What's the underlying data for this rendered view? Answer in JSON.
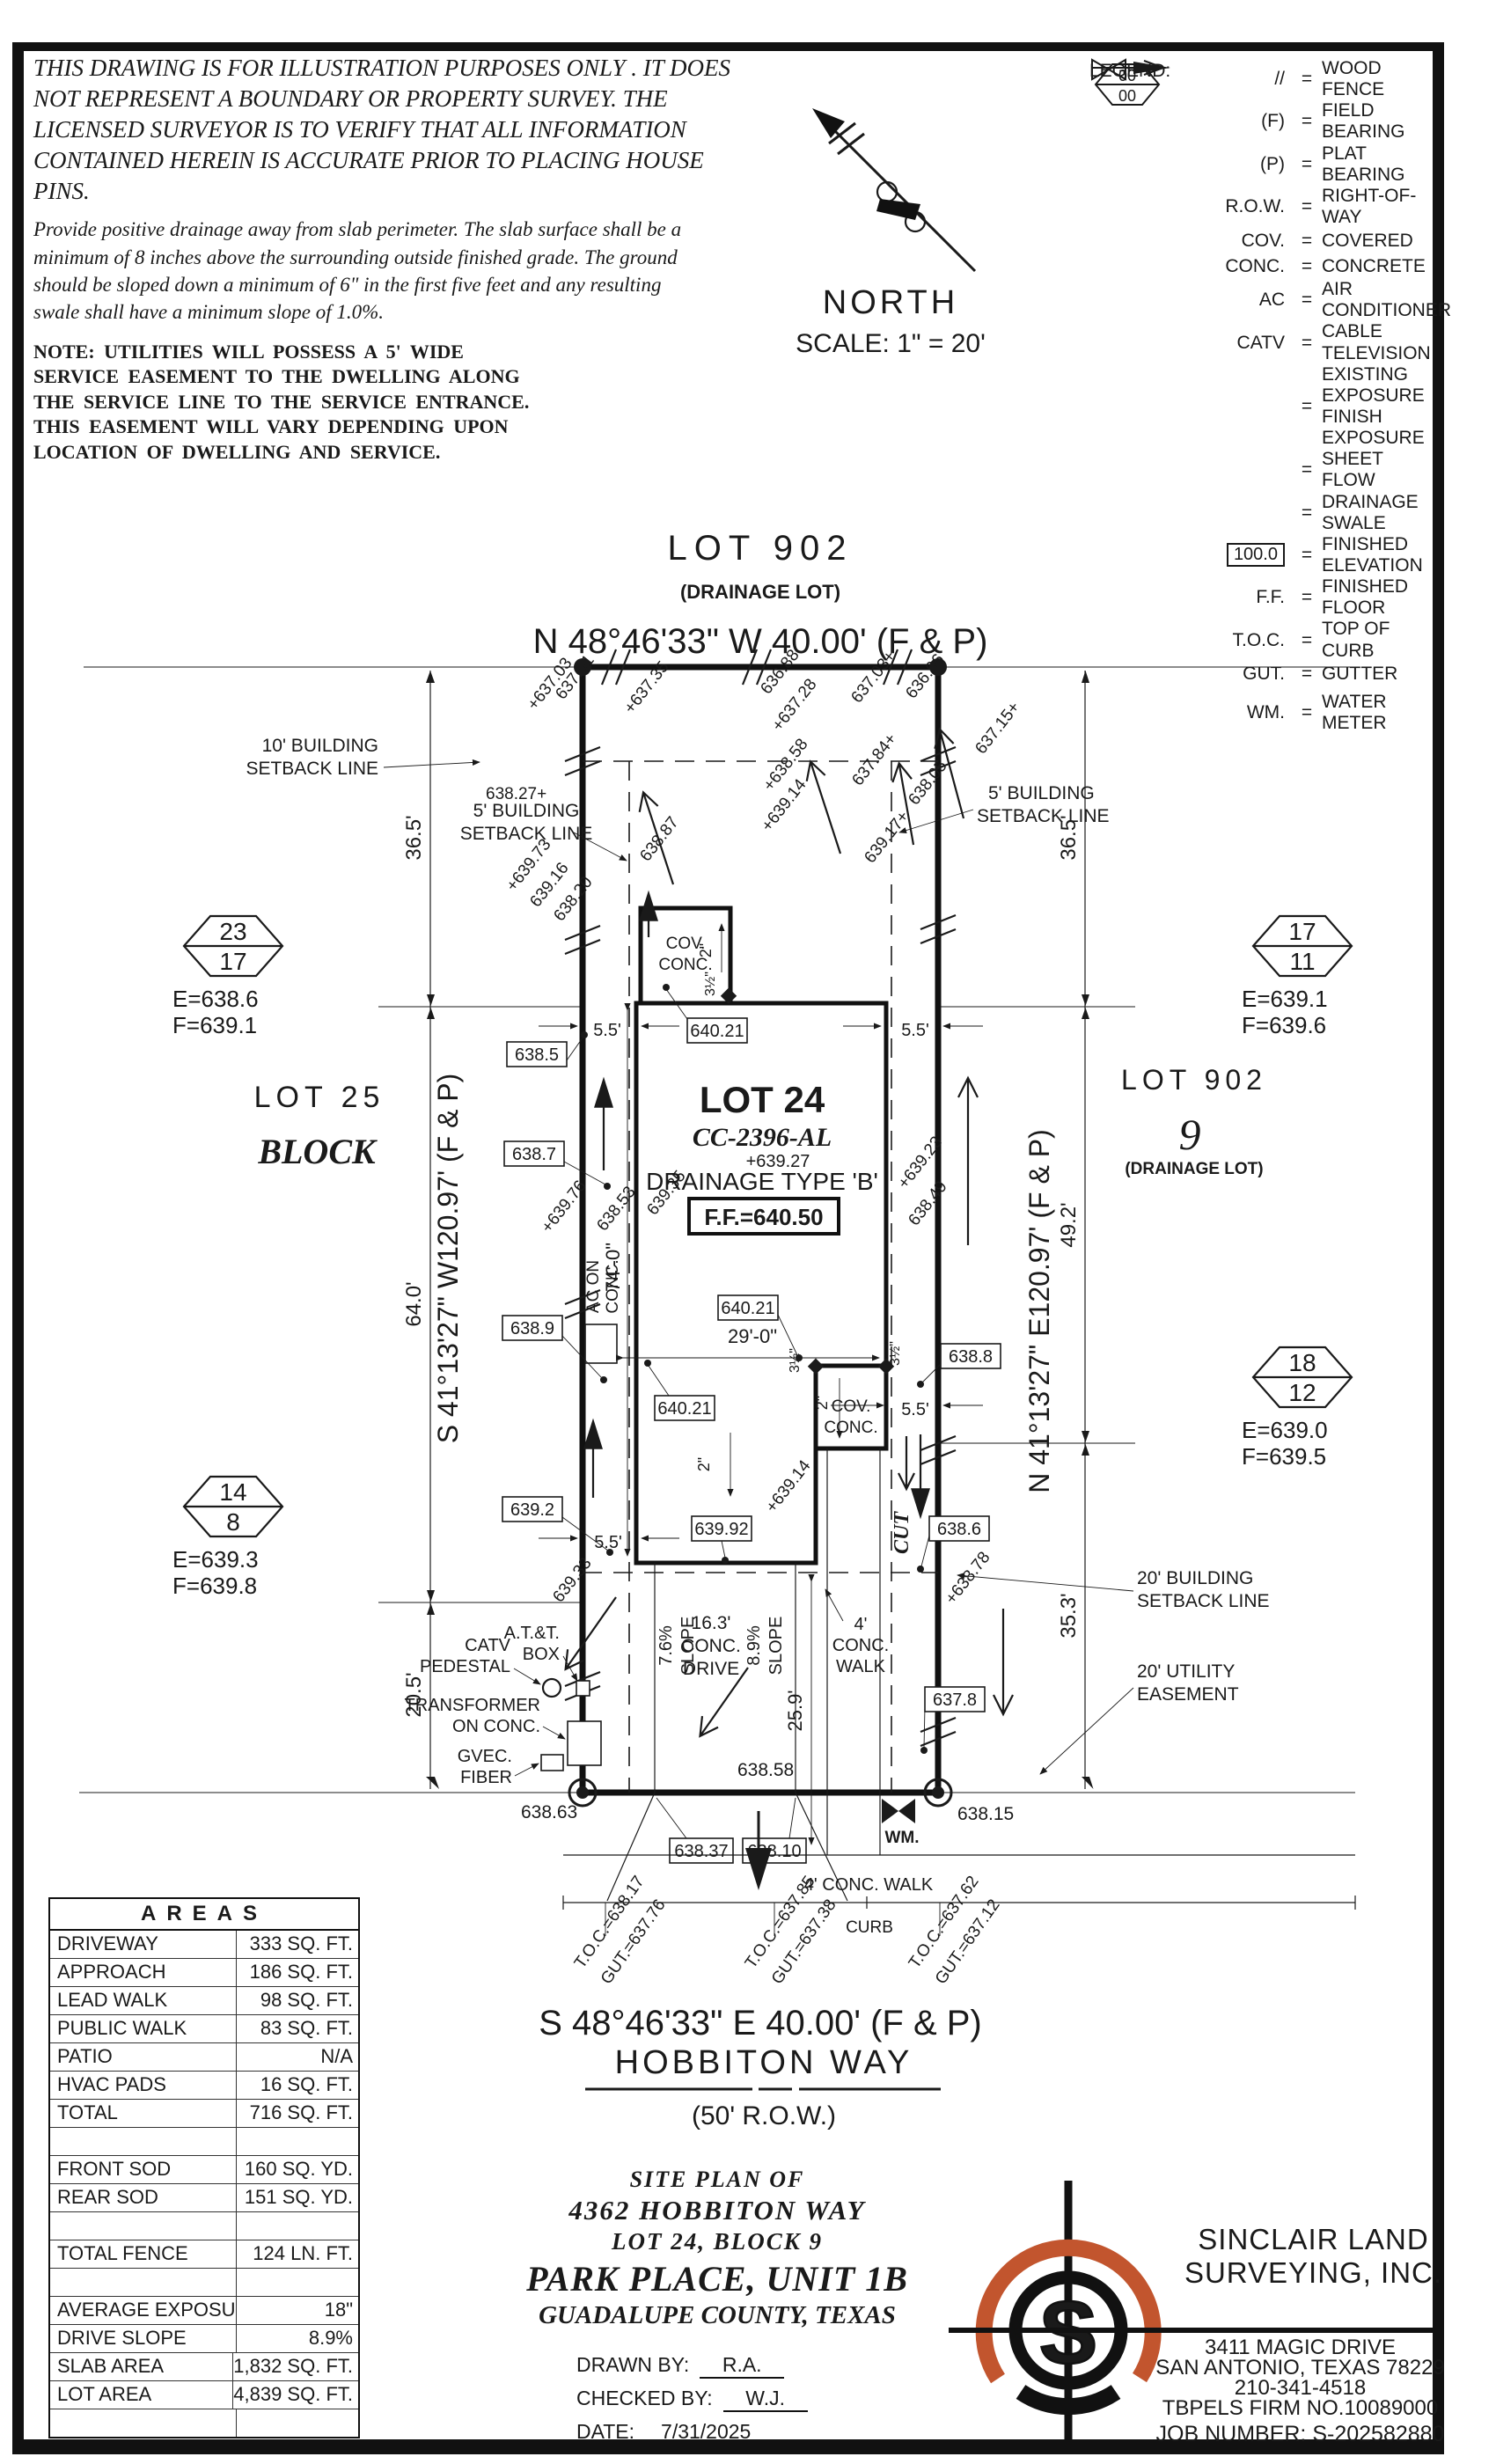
{
  "colors": {
    "ink": "#1a1a1a",
    "accent": "#c2552e"
  },
  "disclaimer": {
    "p1": "THIS DRAWING IS FOR ILLUSTRATION PURPOSES ONLY . IT DOES NOT REPRESENT A BOUNDARY OR PROPERTY SURVEY. THE LICENSED SURVEYOR IS TO VERIFY THAT ALL INFORMATION CONTAINED HEREIN IS ACCURATE PRIOR TO PLACING HOUSE PINS.",
    "p2": "Provide positive drainage away from slab perimeter. The slab surface shall be a minimum of 8 inches above the surrounding outside finished grade. The ground should be sloped down a minimum of 6\" in the first five feet and any resulting swale shall have a minimum slope of 1.0%.",
    "note": "NOTE: UTILITIES WILL POSSESS A 5' WIDE SERVICE EASEMENT TO THE DWELLING ALONG THE SERVICE LINE TO THE SERVICE ENTRANCE. THIS EASEMENT WILL VARY DEPENDING UPON LOCATION OF DWELLING AND SERVICE."
  },
  "north": {
    "label": "NORTH",
    "scale": "SCALE: 1\" = 20'"
  },
  "legend": {
    "title": "LEGEND:",
    "eq": "=",
    "hex_top": "00",
    "hex_bottom": "00",
    "boxnum": "100.0",
    "rows": [
      {
        "sym": "//",
        "label": "WOOD FENCE"
      },
      {
        "sym": "(F)",
        "label": "FIELD BEARING"
      },
      {
        "sym": "(P)",
        "label": "PLAT BEARING"
      },
      {
        "sym": "R.O.W.",
        "label": "RIGHT-OF-WAY"
      },
      {
        "sym": "COV.",
        "label": "COVERED"
      },
      {
        "sym": "CONC.",
        "label": "CONCRETE"
      },
      {
        "sym": "AC",
        "label": "AIR CONDITIONER"
      },
      {
        "sym": "CATV",
        "label": "CABLE TELEVISION"
      },
      {
        "sym": "",
        "label": "EXISTING EXPOSURE",
        "label2": "FINISH EXPOSURE"
      },
      {
        "sym": "",
        "label": "SHEET FLOW"
      },
      {
        "sym": "",
        "label": "DRAINAGE SWALE"
      },
      {
        "sym": "100.0",
        "label": "FINISHED ELEVATION"
      },
      {
        "sym": "F.F.",
        "label": "FINISHED FLOOR"
      },
      {
        "sym": "T.O.C.",
        "label": "TOP OF CURB"
      },
      {
        "sym": "GUT.",
        "label": "GUTTER"
      },
      {
        "sym": "WM.",
        "label": "WATER METER"
      }
    ]
  },
  "plan": {
    "top_lot": "LOT 902",
    "top_lot_sub": "(DRAINAGE LOT)",
    "bearing_n": "N 48°46'33\" W 40.00' (F & P)",
    "bearing_s": "S 48°46'33\" E 40.00' (F & P)",
    "street_name": "HOBBITON WAY",
    "row_label": "(50' R.O.W.)",
    "bearing_w": "S 41°13'27\" W120.97' (F & P)",
    "bearing_e": "N 41°13'27\" E120.97' (F & P)",
    "lot25": "LOT 25",
    "block": "BLOCK",
    "lot902_r": "LOT 902",
    "block9": "9",
    "drainage_lot_r": "(DRAINAGE LOT)",
    "house": {
      "lot": "LOT 24",
      "plan_no": "CC-2396-AL",
      "spot": "+639.27",
      "type": "DRAINAGE TYPE 'B'",
      "ff": "F.F.=640.50",
      "cov1": "COV.",
      "cov2": "CONC."
    },
    "porch_front": {
      "cov1": "COV.",
      "cov2": "CONC."
    },
    "ac1": "AC ON",
    "ac2": "CONC.",
    "cut": "CUT",
    "setbacks": {
      "sb10a": "10' BUILDING",
      "sb10b": "SETBACK LINE",
      "sb5la": "5' BUILDING",
      "sb5lb": "SETBACK LINE",
      "sb5ra": "5' BUILDING",
      "sb5rb": "SETBACK LINE",
      "sb20a": "20' BUILDING",
      "sb20b": "SETBACK LINE",
      "ue20a": "20' UTILITY",
      "ue20b": "EASEMENT"
    },
    "dims": {
      "w365l": "36.5'",
      "w365r": "36.5'",
      "d640": "64.0'",
      "d205": "20.5'",
      "d492": "49.2'",
      "d353": "35.3'",
      "d74": "74'-0\"",
      "d29": "29'-0\"",
      "d55a": "5.5'",
      "d55b": "5.5'",
      "d55c": "5.5'",
      "d55d": "5.5'",
      "d259": "25.9'",
      "drv1": "16.3'",
      "drv2": "CONC.",
      "drv3": "DRIVE",
      "slope1": "7.6%",
      "slope2": "8.9%",
      "slope_word": "SLOPE",
      "walk1": "4'",
      "walk2": "CONC.",
      "walk3": "WALK",
      "walk_street": "4' CONC. WALK",
      "curb": "CURB",
      "in2": "2\"",
      "in35": "3½\""
    },
    "hex": [
      {
        "t": "23",
        "b": "17",
        "e": "E=638.6",
        "f": "F=639.1"
      },
      {
        "t": "17",
        "b": "11",
        "e": "E=639.1",
        "f": "F=639.6"
      },
      {
        "t": "14",
        "b": "8",
        "e": "E=639.3",
        "f": "F=639.8"
      },
      {
        "t": "18",
        "b": "12",
        "e": "E=639.0",
        "f": "F=639.5"
      }
    ],
    "boxed": [
      "640.21",
      "640.21",
      "640.21",
      "638.5",
      "638.7",
      "638.9",
      "639.2",
      "639.92",
      "638.8",
      "638.6",
      "637.8",
      "638.37",
      "638.10"
    ],
    "spots": [
      "+637.03",
      "637.01",
      "+637.35",
      "636.88",
      "+637.28",
      "637.03+",
      "636.96",
      "637.15+",
      "638.05",
      "637.84+",
      "639.17+",
      "+638.58",
      "+639.14",
      "638.87",
      "638.27+",
      "+639.73",
      "639.16",
      "638.20",
      "+639.23",
      "638.49",
      "+639.76",
      "638.53",
      "639.35",
      "639.33",
      "+638.78",
      "+639.14",
      "638.63",
      "638.58",
      "638.15"
    ],
    "utils": {
      "att1": "A.T.&T.",
      "att2": "BOX",
      "catv1": "CATV",
      "catv2": "PEDESTAL",
      "tr1": "TRANSFORMER",
      "tr2": "ON CONC.",
      "gv1": "GVEC.",
      "gv2": "FIBER",
      "wm": "WM."
    },
    "toc": [
      {
        "a": "T.O.C.=638.17",
        "b": "GUT.=637.76"
      },
      {
        "a": "T.O.C.=637.85",
        "b": "GUT.=637.38"
      },
      {
        "a": "T.O.C.=637.62",
        "b": "GUT.=637.12"
      }
    ]
  },
  "areas": {
    "title": "AREAS",
    "rows": [
      {
        "label": "DRIVEWAY",
        "value": "333 SQ. FT."
      },
      {
        "label": "APPROACH",
        "value": "186 SQ. FT."
      },
      {
        "label": "LEAD WALK",
        "value": "98 SQ. FT."
      },
      {
        "label": "PUBLIC WALK",
        "value": "83 SQ. FT."
      },
      {
        "label": "PATIO",
        "value": "N/A"
      },
      {
        "label": "HVAC PADS",
        "value": "16 SQ. FT."
      },
      {
        "label": "TOTAL",
        "value": "716 SQ. FT."
      },
      {
        "label": "",
        "value": ""
      },
      {
        "label": "FRONT SOD",
        "value": "160 SQ. YD."
      },
      {
        "label": "REAR SOD",
        "value": "151 SQ. YD."
      },
      {
        "label": "",
        "value": ""
      },
      {
        "label": "TOTAL FENCE",
        "value": "124 LN. FT."
      },
      {
        "label": "",
        "value": ""
      },
      {
        "label": "AVERAGE EXPOSURE",
        "value": "18\""
      },
      {
        "label": "DRIVE SLOPE",
        "value": "8.9%"
      },
      {
        "label": "SLAB AREA",
        "value": "1,832 SQ. FT."
      },
      {
        "label": "LOT AREA",
        "value": "4,839 SQ. FT."
      },
      {
        "label": "",
        "value": ""
      }
    ]
  },
  "title_block": {
    "l1": "SITE PLAN OF",
    "l2": "4362 HOBBITON WAY",
    "l3": "LOT 24, BLOCK 9",
    "l4": "PARK PLACE, UNIT 1B",
    "l5": "GUADALUPE COUNTY, TEXAS",
    "drawn_label": "DRAWN BY:",
    "drawn": "R.A.",
    "checked_label": "CHECKED BY:",
    "checked": "W.J.",
    "date_label": "DATE:",
    "date": "7/31/2025"
  },
  "firm": {
    "name1": "SINCLAIR LAND",
    "name2": "SURVEYING, INC.",
    "addr1": "3411 MAGIC DRIVE",
    "addr2": "SAN ANTONIO, TEXAS 78229",
    "phone": "210-341-4518",
    "tbpels": "TBPELS FIRM NO.10089000",
    "job": "JOB NUMBER: S-202582880",
    "logo_letter": "S"
  }
}
